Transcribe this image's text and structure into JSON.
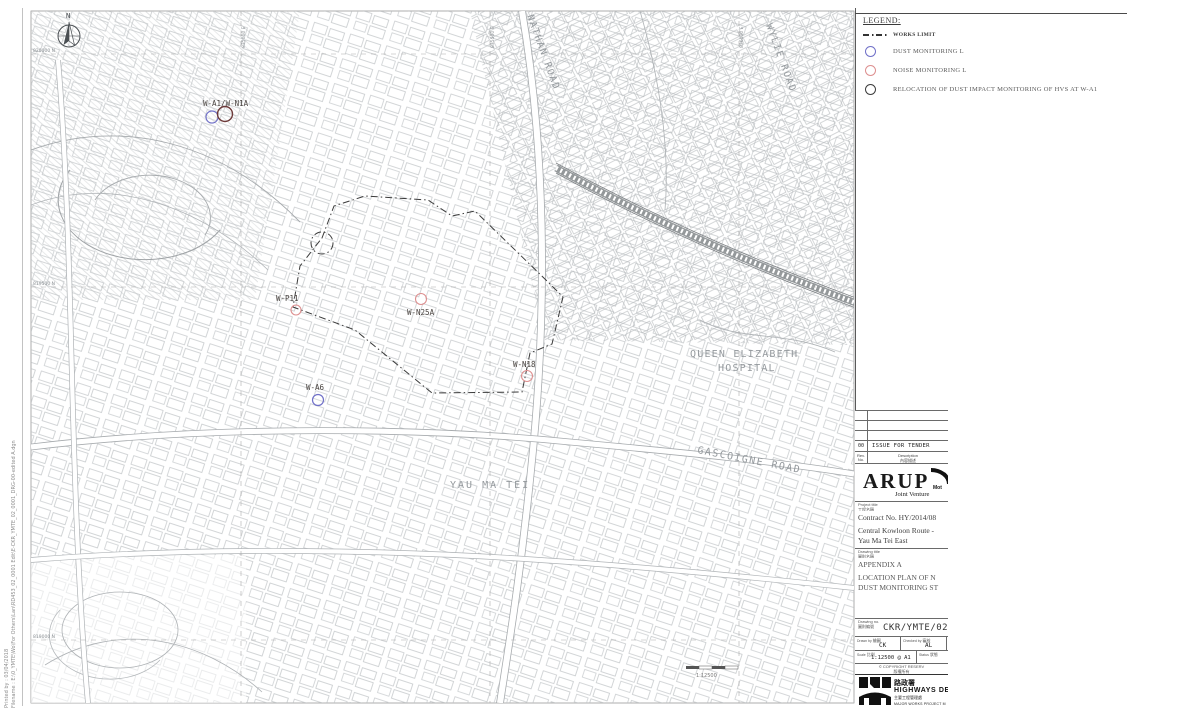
{
  "side_strip": {
    "line1": "Printed by : 03/04/2018",
    "line2": "Filename : E:\\0_YMTE\\Wo\\For Others\\Lan\\RD453_02_0001 Edit\\E-CKR_YMTE_02_0001_DRG-00-edited A.dgn"
  },
  "legend": {
    "title": "LEGEND:",
    "items": [
      {
        "symbol": "works-limit-line",
        "label": "WORKS LIMIT",
        "color": "#333333"
      },
      {
        "symbol": "dust-monitoring-circle",
        "label": "DUST MONITORING L",
        "color": "#7070c8"
      },
      {
        "symbol": "noise-monitoring-circle",
        "label": "NOISE MONITORING L",
        "color": "#dd8f8f"
      },
      {
        "symbol": "relocation-circle",
        "label": "RELOCATION OF DUST IMPACT MONITORING OF HVS AT W-A1",
        "color": "#3d3d3d"
      }
    ]
  },
  "map": {
    "north_label": "N",
    "scale_text": "1:12500",
    "road_labels": [
      {
        "text": "NATHAN ROAD"
      },
      {
        "text": "WYLIE ROAD"
      },
      {
        "text": "GASCOIGNE ROAD"
      },
      {
        "text": "YAU MA TEI"
      },
      {
        "text": "QUEEN ELIZABETH"
      },
      {
        "text": "HOSPITAL"
      }
    ],
    "stations": [
      {
        "label": "W-A1/W-N1A",
        "type": "dust + relocated HVS",
        "x": 212,
        "y": 117,
        "colors": [
          "#7070c8",
          "#6d3a3a"
        ]
      },
      {
        "label": "W-P11",
        "type": "noise",
        "x": 296,
        "y": 310,
        "colors": [
          "#dd8f8f"
        ]
      },
      {
        "label": "W-N25A",
        "type": "noise",
        "x": 421,
        "y": 299,
        "colors": [
          "#dd8f8f"
        ]
      },
      {
        "label": "W-A6",
        "type": "dust",
        "x": 318,
        "y": 400,
        "colors": [
          "#7070c8"
        ]
      },
      {
        "label": "W-N18",
        "type": "noise",
        "x": 527,
        "y": 376,
        "colors": [
          "#dd8f8f"
        ]
      }
    ],
    "grid_labels": {
      "top": [
        "835000 E",
        "835500 E",
        "836000 E"
      ],
      "left": [
        "820000 N",
        "819500 N",
        "819000 N"
      ]
    }
  },
  "title_block": {
    "revision": {
      "no": "00",
      "description": "ISSUE FOR TENDER",
      "rev_header": "Rev. No.",
      "desc_header": "Description",
      "desc_header_cjk": "內容描述"
    },
    "firm": {
      "name": "ARUP",
      "partner_partial": "Mot",
      "joint_venture": "Joint Venture"
    },
    "project": {
      "label": "Project title",
      "label_cjk": "工程名稱",
      "contract": "Contract No. HY/2014/08",
      "name_line1": "Central Kowloon Route -",
      "name_line2": "Yau Ma Tei East"
    },
    "drawing": {
      "label": "Drawing title",
      "label_cjk": "圖則名稱",
      "appendix": "APPENDIX A",
      "title_line1": "LOCATION PLAN OF N",
      "title_line2": "DUST MONITORING ST"
    },
    "number": {
      "label": "Drawing no.",
      "label_cjk": "圖則編號",
      "value": "CKR/YMTE/02/0"
    },
    "people": {
      "drawn_label": "Drawn by",
      "drawn_cjk": "繪圖",
      "drawn": "CK",
      "checked_label": "Checked by",
      "checked_cjk": "審核",
      "checked": "AL"
    },
    "scale": {
      "label": "Scale",
      "label_cjk": "比例",
      "value": "1:12500 @ A1",
      "status_label": "Status",
      "status_cjk": "狀態"
    },
    "copyright": {
      "line1": "© COPYRIGHT RESERV",
      "line2": "版權所有"
    },
    "department": {
      "name_cjk": "路政署",
      "name": "HIGHWAYS DEP",
      "office_cjk": "主要工程管理處",
      "office": "MAJOR WORKS PROJECT M"
    }
  }
}
